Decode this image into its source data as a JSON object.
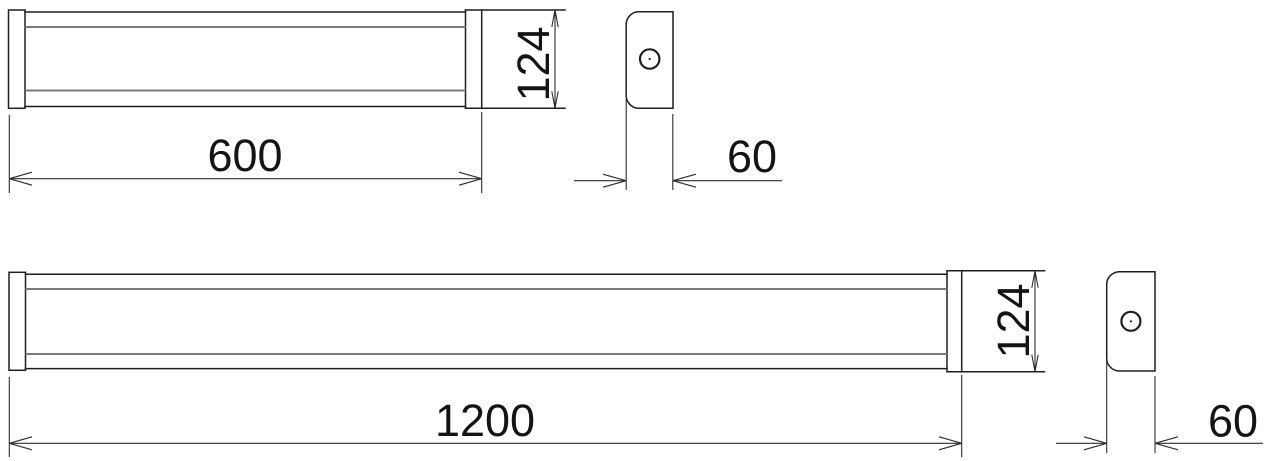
{
  "drawing": {
    "kind": "technical-dimension-drawing",
    "object": "linear-led-batten-luminaire",
    "views": {
      "fixture_600_front": {
        "length_label": "600",
        "height_label": "124"
      },
      "fixture_600_side": {
        "width_label": "60"
      },
      "fixture_1200_front": {
        "length_label": "1200",
        "height_label": "124"
      },
      "fixture_1200_side": {
        "width_label": "60"
      }
    }
  },
  "colors": {
    "background": "#ffffff",
    "outline": "#1f1f1f",
    "inner_line": "#7a7a7a",
    "dimension": "#2e2e2e",
    "text": "#141414"
  }
}
